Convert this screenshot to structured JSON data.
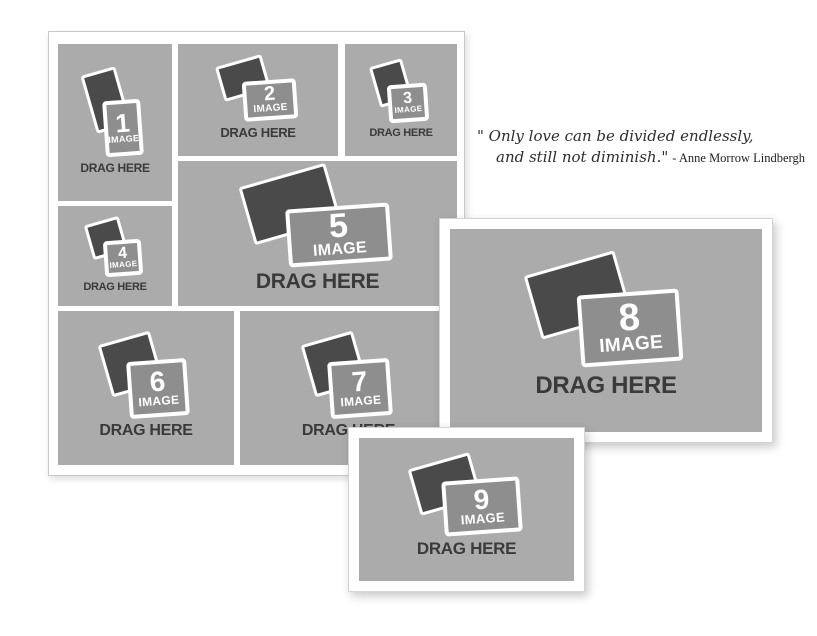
{
  "quote": {
    "line1": "\" Only love can be divided endlessly,",
    "line2": "and still not diminish.\"",
    "attribution": "- Anne Morrow Lindbergh"
  },
  "placeholders": {
    "image_label": "IMAGE",
    "drag_label": "DRAG HERE",
    "cells": [
      {
        "number": "1"
      },
      {
        "number": "2"
      },
      {
        "number": "3"
      },
      {
        "number": "4"
      },
      {
        "number": "5"
      },
      {
        "number": "6"
      },
      {
        "number": "7"
      },
      {
        "number": "8"
      },
      {
        "number": "9"
      }
    ]
  },
  "colors": {
    "page_background": "#ffffff",
    "cell_background": "#ababab",
    "icon_front": "#8e8e8e",
    "icon_back": "#4a4a4a",
    "frame": "#ffffff",
    "drag_text": "#3a3a3a",
    "quote_text": "#2e2e2e"
  }
}
